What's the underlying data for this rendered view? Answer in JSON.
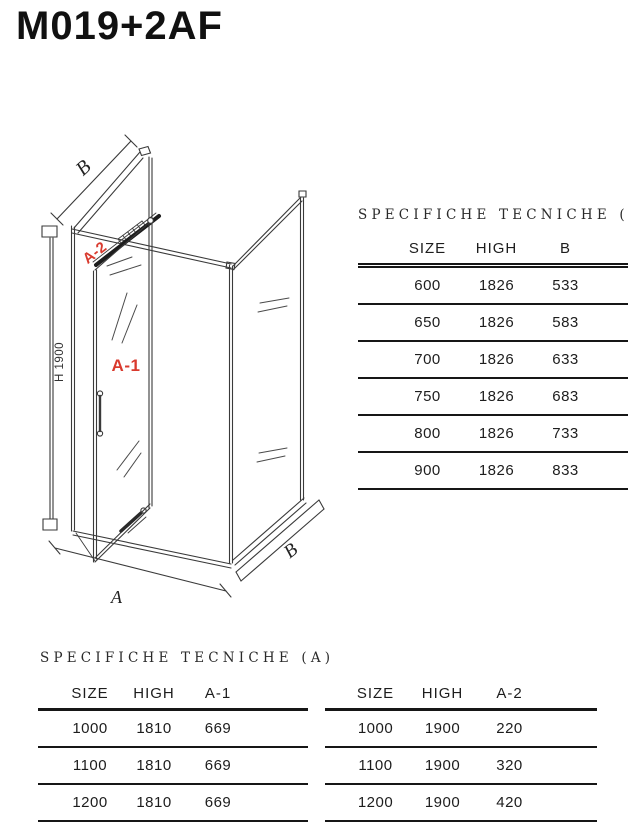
{
  "page_title": "M019+2AF",
  "diagram": {
    "labels": {
      "b_top": "B",
      "a2": "A-2",
      "a1": "A-1",
      "h": "H 1900",
      "a_bottom": "A",
      "b_bottom": "B"
    },
    "colors": {
      "red_label": "#d93a2e",
      "line": "#3a3a3a"
    }
  },
  "table_b": {
    "title": "SPECIFICHE TECNICHE (B)",
    "columns": [
      "SIZE",
      "HIGH",
      "B"
    ],
    "rows": [
      [
        "600",
        "1826",
        "533"
      ],
      [
        "650",
        "1826",
        "583"
      ],
      [
        "700",
        "1826",
        "633"
      ],
      [
        "750",
        "1826",
        "683"
      ],
      [
        "800",
        "1826",
        "733"
      ],
      [
        "900",
        "1826",
        "833"
      ]
    ]
  },
  "table_a1": {
    "title": "SPECIFICHE TECNICHE (A)",
    "columns": [
      "SIZE",
      "HIGH",
      "A-1"
    ],
    "rows": [
      [
        "1000",
        "1810",
        "669"
      ],
      [
        "1100",
        "1810",
        "669"
      ],
      [
        "1200",
        "1810",
        "669"
      ]
    ]
  },
  "table_a2": {
    "columns": [
      "SIZE",
      "HIGH",
      "A-2"
    ],
    "rows": [
      [
        "1000",
        "1900",
        "220"
      ],
      [
        "1100",
        "1900",
        "320"
      ],
      [
        "1200",
        "1900",
        "420"
      ]
    ]
  }
}
